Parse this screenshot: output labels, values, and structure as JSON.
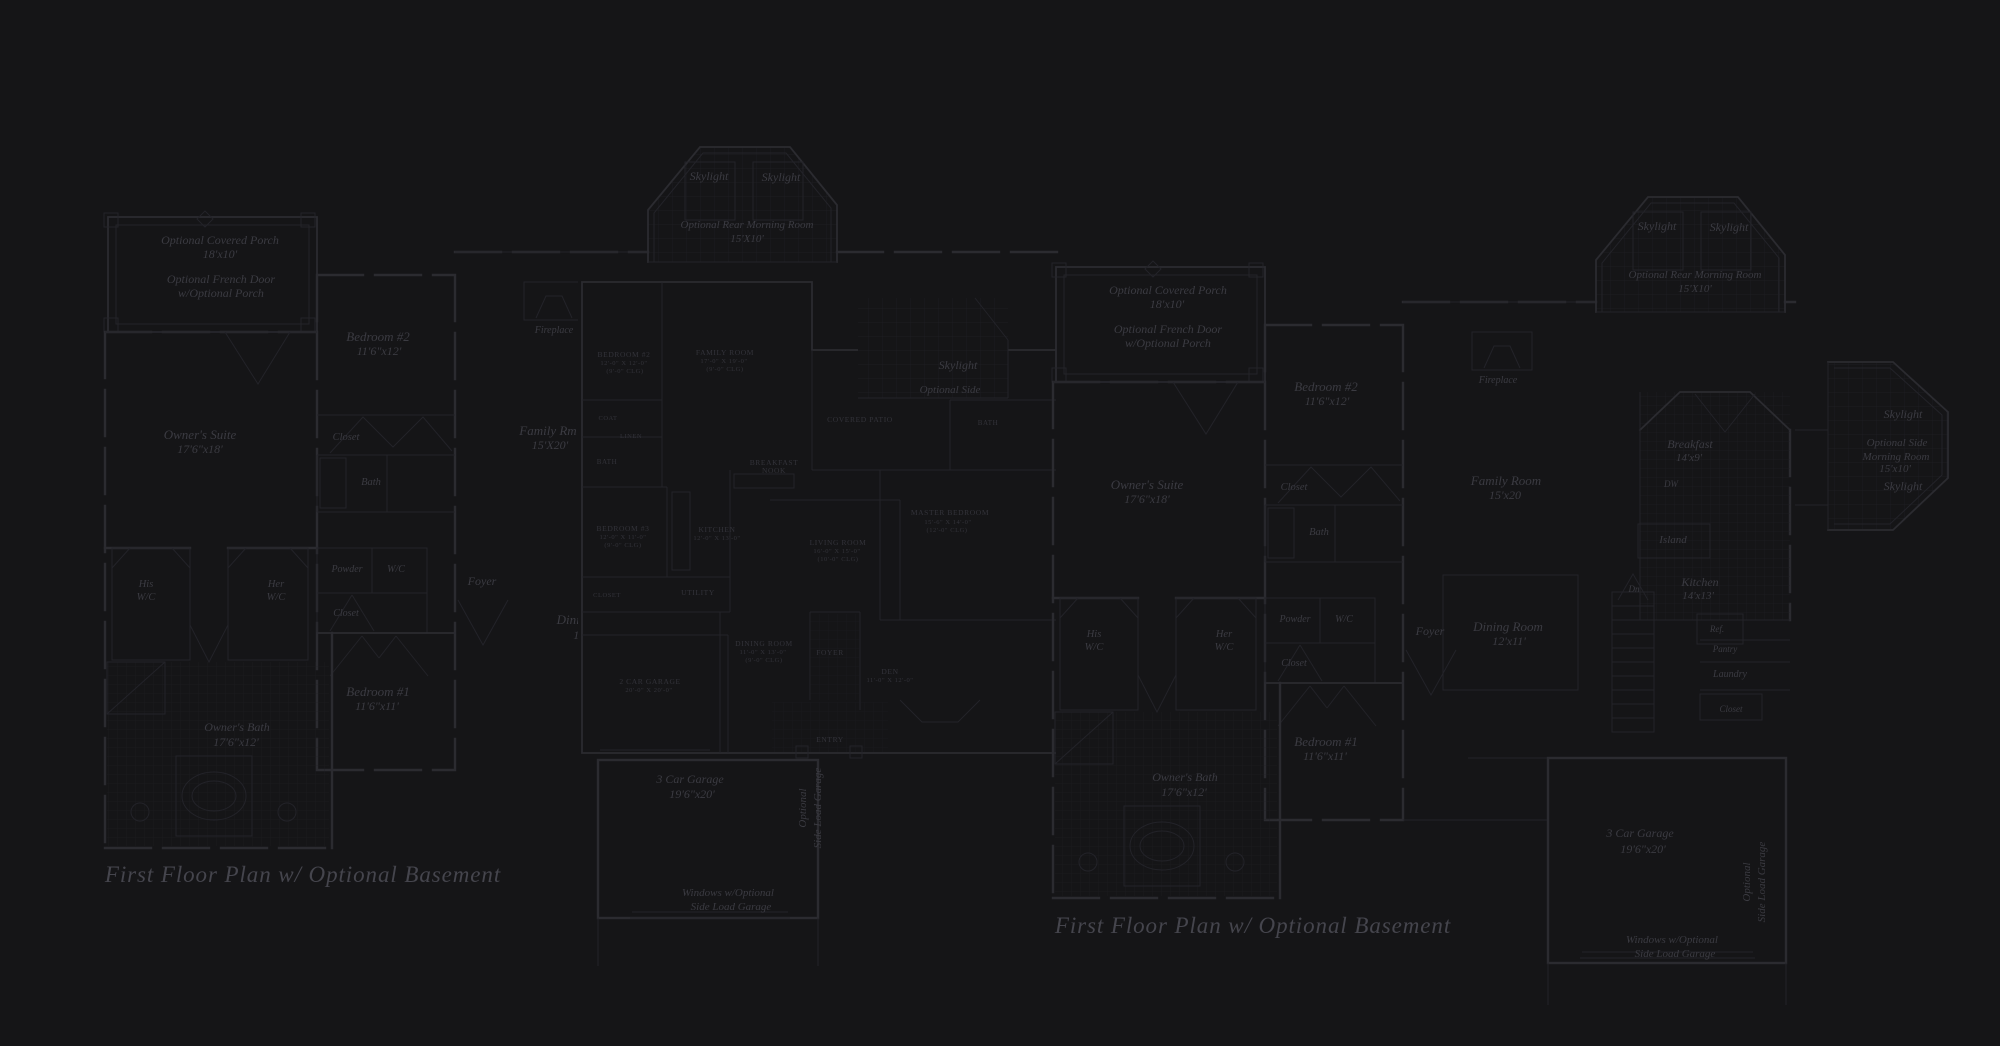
{
  "colors": {
    "bg": "#151517",
    "wall": "#2b2b30",
    "wall-light": "#232329",
    "grid": "#1e1e23",
    "ink": "#3b3b42",
    "ink-dim": "#33333a",
    "title": "#45454d"
  },
  "titles": {
    "left": "First Floor Plan  w/ Optional Basement",
    "right": "First Floor Plan  w/ Optional Basement"
  },
  "labels": [
    {
      "n": "left-opt-covered-porch",
      "l": "L",
      "t": "Optional Covered Porch",
      "x": 220,
      "y": 244,
      "s": 12
    },
    {
      "n": "left-opt-covered-porch-dim",
      "l": "L",
      "t": "18'x10'",
      "x": 220,
      "y": 258,
      "s": 12
    },
    {
      "n": "left-opt-french-door",
      "l": "L",
      "t": "Optional French Door",
      "x": 221,
      "y": 283,
      "s": 12
    },
    {
      "n": "left-opt-french-door-2",
      "l": "L",
      "t": "w/Optional Porch",
      "x": 221,
      "y": 297,
      "s": 12
    },
    {
      "n": "left-bedroom2",
      "l": "L",
      "t": "Bedroom #2",
      "x": 378,
      "y": 341,
      "s": 13
    },
    {
      "n": "left-bedroom2-dim",
      "l": "L",
      "t": "11'6\"x12'",
      "x": 379,
      "y": 355,
      "s": 12
    },
    {
      "n": "left-owners-suite",
      "l": "L",
      "t": "Owner's Suite",
      "x": 200,
      "y": 439,
      "s": 13
    },
    {
      "n": "left-owners-suite-dim",
      "l": "L",
      "t": "17'6\"x18'",
      "x": 200,
      "y": 453,
      "s": 12
    },
    {
      "n": "left-closet",
      "l": "L",
      "t": "Closet",
      "x": 346,
      "y": 440,
      "s": 10.5
    },
    {
      "n": "left-bath",
      "l": "L",
      "t": "Bath",
      "x": 371,
      "y": 485,
      "s": 10.5
    },
    {
      "n": "left-his",
      "l": "L",
      "t": "His",
      "x": 146,
      "y": 587,
      "s": 10.5
    },
    {
      "n": "left-his-wc",
      "l": "L",
      "t": "W/C",
      "x": 146,
      "y": 600,
      "s": 10.5
    },
    {
      "n": "left-her",
      "l": "L",
      "t": "Her",
      "x": 276,
      "y": 587,
      "s": 10.5
    },
    {
      "n": "left-her-wc",
      "l": "L",
      "t": "W/C",
      "x": 276,
      "y": 600,
      "s": 10.5
    },
    {
      "n": "left-powder",
      "l": "L",
      "t": "Powder",
      "x": 347,
      "y": 572,
      "s": 10
    },
    {
      "n": "left-wc",
      "l": "L",
      "t": "W/C",
      "x": 396,
      "y": 572,
      "s": 10
    },
    {
      "n": "left-closet-2",
      "l": "L",
      "t": "Closet",
      "x": 346,
      "y": 616,
      "s": 10
    },
    {
      "n": "left-foyer",
      "l": "L",
      "t": "Foyer",
      "x": 482,
      "y": 585,
      "s": 12
    },
    {
      "n": "left-family-rm",
      "l": "L",
      "t": "Family Rm",
      "x": 548,
      "y": 435,
      "s": 13
    },
    {
      "n": "left-family-rm-dim",
      "l": "L",
      "t": "15'X20'",
      "x": 550,
      "y": 449,
      "s": 12
    },
    {
      "n": "left-dining",
      "l": "L",
      "t": "Dining Rm",
      "x": 585,
      "y": 624,
      "s": 13
    },
    {
      "n": "left-dining-dim",
      "l": "L",
      "t": "12'x11'",
      "x": 590,
      "y": 639,
      "s": 12
    },
    {
      "n": "left-fireplace",
      "l": "L",
      "t": "Fireplace",
      "x": 554,
      "y": 333,
      "s": 10
    },
    {
      "n": "left-bedroom1",
      "l": "L",
      "t": "Bedroom #1",
      "x": 378,
      "y": 696,
      "s": 13
    },
    {
      "n": "left-bedroom1-dim",
      "l": "L",
      "t": "11'6\"x11'",
      "x": 377,
      "y": 710,
      "s": 12
    },
    {
      "n": "left-owners-bath",
      "l": "L",
      "t": "Owner's Bath",
      "x": 237,
      "y": 731,
      "s": 12
    },
    {
      "n": "left-owners-bath-dim",
      "l": "L",
      "t": "17'6\"x12'",
      "x": 236,
      "y": 746,
      "s": 12
    },
    {
      "n": "left-skylight-1",
      "l": "L",
      "t": "Skylight",
      "x": 709,
      "y": 180,
      "s": 12
    },
    {
      "n": "left-skylight-2",
      "l": "L",
      "t": "Skylight",
      "x": 781,
      "y": 181,
      "s": 12
    },
    {
      "n": "left-rear-morning-room",
      "l": "L",
      "t": "Optional Rear Morning Room",
      "x": 747,
      "y": 228,
      "s": 11
    },
    {
      "n": "left-rear-morning-room-dim",
      "l": "L",
      "t": "15'X10'",
      "x": 747,
      "y": 242,
      "s": 11
    },
    {
      "n": "left-garage",
      "l": "L",
      "t": "3 Car Garage",
      "x": 690,
      "y": 783,
      "s": 12
    },
    {
      "n": "left-garage-dim",
      "l": "L",
      "t": "19'6\"x20'",
      "x": 692,
      "y": 798,
      "s": 12
    },
    {
      "n": "left-side-load-1",
      "l": "L",
      "t": "Optional",
      "x": 806,
      "y": 808,
      "s": 11,
      "r": -90
    },
    {
      "n": "left-side-load-2",
      "l": "L",
      "t": "Side Load Garage",
      "x": 821,
      "y": 808,
      "s": 11,
      "r": -90
    },
    {
      "n": "left-windows-note",
      "l": "L",
      "t": "Windows w/Optional",
      "x": 728,
      "y": 896,
      "s": 11
    },
    {
      "n": "left-windows-note-2",
      "l": "L",
      "t": "Side Load Garage",
      "x": 731,
      "y": 910,
      "s": 11
    },
    {
      "n": "mid-bedroom2",
      "l": "M",
      "t": "BEDROOM #2",
      "x": 624,
      "y": 357,
      "s": 7.5,
      "c": "caps"
    },
    {
      "n": "mid-bedroom2-dim",
      "l": "M",
      "t": "12'-0\" X 12'-0\"",
      "x": 624,
      "y": 365,
      "s": 6.5,
      "c": "caps"
    },
    {
      "n": "mid-bedroom2-clg",
      "l": "M",
      "t": "(9'-0\" CLG)",
      "x": 625,
      "y": 373,
      "s": 6.5,
      "c": "caps"
    },
    {
      "n": "mid-family-room",
      "l": "M",
      "t": "FAMILY ROOM",
      "x": 725,
      "y": 355,
      "s": 7.5,
      "c": "caps"
    },
    {
      "n": "mid-family-room-dim",
      "l": "M",
      "t": "17'-0\" X 19'-0\"",
      "x": 724,
      "y": 363,
      "s": 6.5,
      "c": "caps"
    },
    {
      "n": "mid-family-room-clg",
      "l": "M",
      "t": "(9'-0\" CLG)",
      "x": 725,
      "y": 371,
      "s": 6.5,
      "c": "caps"
    },
    {
      "n": "mid-covered-patio",
      "l": "M",
      "t": "COVERED PATIO",
      "x": 860,
      "y": 422,
      "s": 7.5,
      "c": "caps"
    },
    {
      "n": "mid-coat",
      "l": "M",
      "t": "COAT",
      "x": 608,
      "y": 420,
      "s": 6.5,
      "c": "caps"
    },
    {
      "n": "mid-linen",
      "l": "M",
      "t": "LINEN",
      "x": 631,
      "y": 438,
      "s": 6.5,
      "c": "caps"
    },
    {
      "n": "mid-bath",
      "l": "M",
      "t": "BATH",
      "x": 607,
      "y": 464,
      "s": 7,
      "c": "caps"
    },
    {
      "n": "mid-bedroom3",
      "l": "M",
      "t": "BEDROOM #3",
      "x": 623,
      "y": 531,
      "s": 7.5,
      "c": "caps"
    },
    {
      "n": "mid-bedroom3-dim",
      "l": "M",
      "t": "12'-0\" X 11'-0\"",
      "x": 623,
      "y": 539,
      "s": 6.5,
      "c": "caps"
    },
    {
      "n": "mid-bedroom3-clg",
      "l": "M",
      "t": "(9'-0\" CLG)",
      "x": 623,
      "y": 547,
      "s": 6.5,
      "c": "caps"
    },
    {
      "n": "mid-kitchen",
      "l": "M",
      "t": "KITCHEN",
      "x": 717,
      "y": 532,
      "s": 7.5,
      "c": "caps"
    },
    {
      "n": "mid-kitchen-dim",
      "l": "M",
      "t": "12'-0\" X 13'-0\"",
      "x": 717,
      "y": 540,
      "s": 6.5,
      "c": "caps"
    },
    {
      "n": "mid-breakfast-nook",
      "l": "M",
      "t": "BREAKFAST",
      "x": 774,
      "y": 465,
      "s": 7.5,
      "c": "caps"
    },
    {
      "n": "mid-breakfast-nook-2",
      "l": "M",
      "t": "NOOK",
      "x": 774,
      "y": 473,
      "s": 7.5,
      "c": "caps"
    },
    {
      "n": "mid-living-room",
      "l": "M",
      "t": "LIVING ROOM",
      "x": 838,
      "y": 545,
      "s": 7.5,
      "c": "caps"
    },
    {
      "n": "mid-living-room-dim",
      "l": "M",
      "t": "16'-0\" X 15'-0\"",
      "x": 837,
      "y": 553,
      "s": 6.5,
      "c": "caps"
    },
    {
      "n": "mid-living-room-clg",
      "l": "M",
      "t": "(10'-0\" CLG)",
      "x": 838,
      "y": 561,
      "s": 6.5,
      "c": "caps"
    },
    {
      "n": "mid-utility",
      "l": "M",
      "t": "UTILITY",
      "x": 698,
      "y": 595,
      "s": 7.5,
      "c": "caps"
    },
    {
      "n": "mid-closet",
      "l": "M",
      "t": "CLOSET",
      "x": 607,
      "y": 597,
      "s": 6.5,
      "c": "caps"
    },
    {
      "n": "mid-bath2",
      "l": "M",
      "t": "BATH",
      "x": 988,
      "y": 425,
      "s": 7,
      "c": "caps"
    },
    {
      "n": "mid-master-bedroom",
      "l": "M",
      "t": "MASTER BEDROOM",
      "x": 950,
      "y": 515,
      "s": 7.5,
      "c": "caps"
    },
    {
      "n": "mid-master-bedroom-dim",
      "l": "M",
      "t": "15'-6\" X 14'-0\"",
      "x": 948,
      "y": 524,
      "s": 6.5,
      "c": "caps"
    },
    {
      "n": "mid-master-bedroom-clg",
      "l": "M",
      "t": "(12'-0\" CLG)",
      "x": 947,
      "y": 532,
      "s": 6.5,
      "c": "caps"
    },
    {
      "n": "mid-dining-room",
      "l": "M",
      "t": "DINING ROOM",
      "x": 764,
      "y": 646,
      "s": 7.5,
      "c": "caps"
    },
    {
      "n": "mid-dining-room-dim",
      "l": "M",
      "t": "11'-0\" X 13'-0\"",
      "x": 763,
      "y": 654,
      "s": 6.5,
      "c": "caps"
    },
    {
      "n": "mid-dining-room-clg",
      "l": "M",
      "t": "(9'-0\" CLG)",
      "x": 764,
      "y": 662,
      "s": 6.5,
      "c": "caps"
    },
    {
      "n": "mid-foyer",
      "l": "M",
      "t": "FOYER",
      "x": 830,
      "y": 655,
      "s": 7.5,
      "c": "caps"
    },
    {
      "n": "mid-den",
      "l": "M",
      "t": "DEN",
      "x": 890,
      "y": 674,
      "s": 7.5,
      "c": "caps"
    },
    {
      "n": "mid-den-dim",
      "l": "M",
      "t": "11'-0\" X 12'-0\"",
      "x": 890,
      "y": 682,
      "s": 6.5,
      "c": "caps"
    },
    {
      "n": "mid-entry",
      "l": "M",
      "t": "ENTRY",
      "x": 830,
      "y": 742,
      "s": 7.5,
      "c": "caps"
    },
    {
      "n": "mid-garage",
      "l": "M",
      "t": "2 CAR GARAGE",
      "x": 650,
      "y": 684,
      "s": 7.5,
      "c": "caps"
    },
    {
      "n": "mid-garage-dim",
      "l": "M",
      "t": "20'-0\" X 20'-0\"",
      "x": 649,
      "y": 692,
      "s": 6.5,
      "c": "caps"
    },
    {
      "n": "mid-skylight",
      "l": "F1",
      "t": "Skylight",
      "x": 958,
      "y": 369,
      "s": 12
    },
    {
      "n": "mid-optional-side",
      "l": "F1",
      "t": "Optional Side",
      "x": 950,
      "y": 393,
      "s": 11
    },
    {
      "n": "right-opt-covered-porch",
      "l": "R",
      "t": "Optional Covered Porch",
      "x": 1168,
      "y": 294,
      "s": 12
    },
    {
      "n": "right-opt-covered-porch-dim",
      "l": "R",
      "t": "18'x10'",
      "x": 1167,
      "y": 308,
      "s": 12
    },
    {
      "n": "right-opt-french-door",
      "l": "R",
      "t": "Optional French Door",
      "x": 1168,
      "y": 333,
      "s": 12
    },
    {
      "n": "right-opt-french-door-2",
      "l": "R",
      "t": "w/Optional Porch",
      "x": 1168,
      "y": 347,
      "s": 12
    },
    {
      "n": "right-bedroom2",
      "l": "R",
      "t": "Bedroom #2",
      "x": 1326,
      "y": 391,
      "s": 13
    },
    {
      "n": "right-bedroom2-dim",
      "l": "R",
      "t": "11'6\"x12'",
      "x": 1327,
      "y": 405,
      "s": 12
    },
    {
      "n": "right-owners-suite",
      "l": "R",
      "t": "Owner's Suite",
      "x": 1147,
      "y": 489,
      "s": 13
    },
    {
      "n": "right-owners-suite-dim",
      "l": "R",
      "t": "17'6\"x18'",
      "x": 1147,
      "y": 503,
      "s": 12
    },
    {
      "n": "right-closet",
      "l": "R",
      "t": "Closet",
      "x": 1294,
      "y": 490,
      "s": 10.5
    },
    {
      "n": "right-bath",
      "l": "R",
      "t": "Bath",
      "x": 1319,
      "y": 535,
      "s": 10.5
    },
    {
      "n": "right-his",
      "l": "R",
      "t": "His",
      "x": 1094,
      "y": 637,
      "s": 10.5
    },
    {
      "n": "right-his-wc",
      "l": "R",
      "t": "W/C",
      "x": 1094,
      "y": 650,
      "s": 10.5
    },
    {
      "n": "right-her",
      "l": "R",
      "t": "Her",
      "x": 1224,
      "y": 637,
      "s": 10.5
    },
    {
      "n": "right-her-wc",
      "l": "R",
      "t": "W/C",
      "x": 1224,
      "y": 650,
      "s": 10.5
    },
    {
      "n": "right-powder",
      "l": "R",
      "t": "Powder",
      "x": 1295,
      "y": 622,
      "s": 10
    },
    {
      "n": "right-wc",
      "l": "R",
      "t": "W/C",
      "x": 1344,
      "y": 622,
      "s": 10
    },
    {
      "n": "right-closet-2",
      "l": "R",
      "t": "Closet",
      "x": 1294,
      "y": 666,
      "s": 10
    },
    {
      "n": "right-foyer",
      "l": "R",
      "t": "Foyer",
      "x": 1430,
      "y": 635,
      "s": 12
    },
    {
      "n": "right-fireplace",
      "l": "R",
      "t": "Fireplace",
      "x": 1498,
      "y": 383,
      "s": 10
    },
    {
      "n": "right-family-room",
      "l": "R",
      "t": "Family Room",
      "x": 1506,
      "y": 485,
      "s": 13
    },
    {
      "n": "right-family-room-dim",
      "l": "R",
      "t": "15'x20",
      "x": 1505,
      "y": 499,
      "s": 12
    },
    {
      "n": "right-breakfast",
      "l": "R",
      "t": "Breakfast",
      "x": 1690,
      "y": 448,
      "s": 12
    },
    {
      "n": "right-breakfast-dim",
      "l": "R",
      "t": "14'x9'",
      "x": 1689,
      "y": 461,
      "s": 11
    },
    {
      "n": "right-dw",
      "l": "R",
      "t": "DW",
      "x": 1671,
      "y": 487,
      "s": 9
    },
    {
      "n": "right-island",
      "l": "R",
      "t": "Island",
      "x": 1673,
      "y": 543,
      "s": 11
    },
    {
      "n": "right-kitchen",
      "l": "R",
      "t": "Kitchen",
      "x": 1700,
      "y": 586,
      "s": 12
    },
    {
      "n": "right-kitchen-dim",
      "l": "R",
      "t": "14'x13'",
      "x": 1698,
      "y": 599,
      "s": 11
    },
    {
      "n": "right-ref",
      "l": "R",
      "t": "Ref.",
      "x": 1717,
      "y": 632,
      "s": 9
    },
    {
      "n": "right-pantry",
      "l": "R",
      "t": "Pantry",
      "x": 1725,
      "y": 652,
      "s": 9
    },
    {
      "n": "right-laundry",
      "l": "R",
      "t": "Laundry",
      "x": 1730,
      "y": 677,
      "s": 10
    },
    {
      "n": "right-closet-3",
      "l": "R",
      "t": "Closet",
      "x": 1731,
      "y": 712,
      "s": 9
    },
    {
      "n": "right-dn",
      "l": "R",
      "t": "Dn",
      "x": 1634,
      "y": 592,
      "s": 9
    },
    {
      "n": "right-dining-room",
      "l": "R",
      "t": "Dining Room",
      "x": 1508,
      "y": 631,
      "s": 13
    },
    {
      "n": "right-dining-room-dim",
      "l": "R",
      "t": "12'x11'",
      "x": 1509,
      "y": 645,
      "s": 12
    },
    {
      "n": "right-bedroom1",
      "l": "R",
      "t": "Bedroom #1",
      "x": 1326,
      "y": 746,
      "s": 13
    },
    {
      "n": "right-bedroom1-dim",
      "l": "R",
      "t": "11'6\"x11'",
      "x": 1325,
      "y": 760,
      "s": 12
    },
    {
      "n": "right-owners-bath",
      "l": "R",
      "t": "Owner's Bath",
      "x": 1185,
      "y": 781,
      "s": 12
    },
    {
      "n": "right-owners-bath-dim",
      "l": "R",
      "t": "17'6\"x12'",
      "x": 1184,
      "y": 796,
      "s": 12
    },
    {
      "n": "right-skylight-1",
      "l": "R",
      "t": "Skylight",
      "x": 1657,
      "y": 230,
      "s": 12
    },
    {
      "n": "right-skylight-2",
      "l": "R",
      "t": "Skylight",
      "x": 1729,
      "y": 231,
      "s": 12
    },
    {
      "n": "right-rear-morning-room",
      "l": "R",
      "t": "Optional Rear Morning Room",
      "x": 1695,
      "y": 278,
      "s": 11
    },
    {
      "n": "right-rear-morning-room-dim",
      "l": "R",
      "t": "15'X10'",
      "x": 1695,
      "y": 292,
      "s": 11
    },
    {
      "n": "right-garage",
      "l": "R",
      "t": "3 Car Garage",
      "x": 1640,
      "y": 837,
      "s": 12
    },
    {
      "n": "right-garage-dim",
      "l": "R",
      "t": "19'6\"x20'",
      "x": 1643,
      "y": 853,
      "s": 12
    },
    {
      "n": "right-side-load-1",
      "l": "R",
      "t": "Optional",
      "x": 1750,
      "y": 882,
      "s": 11,
      "r": -90
    },
    {
      "n": "right-side-load-2",
      "l": "R",
      "t": "Side Load Garage",
      "x": 1765,
      "y": 882,
      "s": 11,
      "r": -90
    },
    {
      "n": "right-windows-note",
      "l": "R",
      "t": "Windows w/Optional",
      "x": 1672,
      "y": 943,
      "s": 11
    },
    {
      "n": "right-windows-note-2",
      "l": "R",
      "t": "Side Load Garage",
      "x": 1675,
      "y": 957,
      "s": 11
    },
    {
      "n": "side-skylight-1",
      "l": "F2",
      "t": "Skylight",
      "x": 1903,
      "y": 418,
      "s": 12
    },
    {
      "n": "side-morning-room",
      "l": "F2",
      "t": "Optional Side",
      "x": 1897,
      "y": 446,
      "s": 11
    },
    {
      "n": "side-morning-room-2",
      "l": "F2",
      "t": "Morning Room",
      "x": 1896,
      "y": 460,
      "s": 11
    },
    {
      "n": "side-morning-room-dim",
      "l": "F2",
      "t": "15'x10'",
      "x": 1895,
      "y": 472,
      "s": 11
    },
    {
      "n": "side-skylight-2",
      "l": "F2",
      "t": "Skylight",
      "x": 1903,
      "y": 490,
      "s": 12
    }
  ]
}
